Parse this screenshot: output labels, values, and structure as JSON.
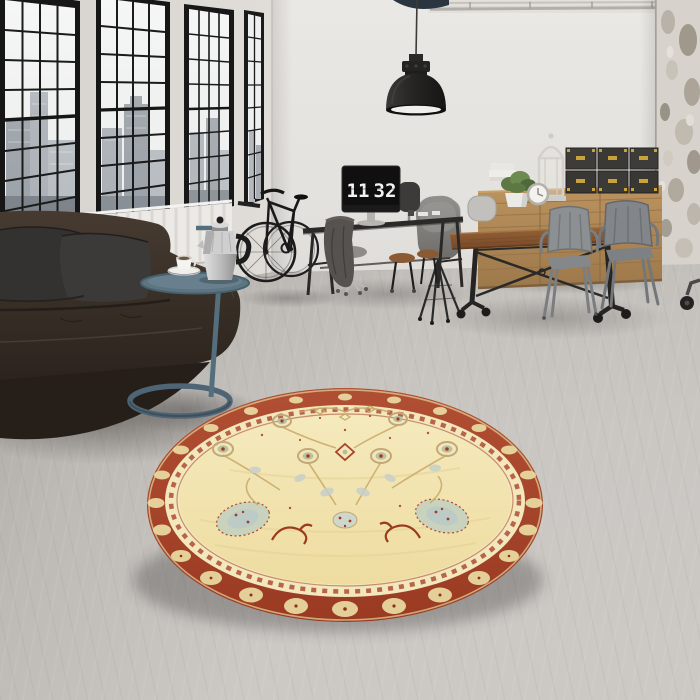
{
  "scene": {
    "type": "interior-product-photo",
    "subject": "Round cream and red oriental rug in an industrial loft living room",
    "monitor_clock": {
      "hours": "11",
      "minutes": "32"
    }
  },
  "objects": [
    "loft-windows",
    "city-view",
    "radiator",
    "leather-sofa",
    "throw-pillows",
    "side-table",
    "moka-pot",
    "coffee-cup",
    "wall-bike",
    "work-desk",
    "flip-clock-monitor",
    "office-stools",
    "draped-blanket",
    "pendant-lamp",
    "ceiling-pipe",
    "dining-table",
    "shell-chairs",
    "tolix-armchairs",
    "wood-sideboard",
    "storage-trunks",
    "potted-plant",
    "lantern",
    "table-clock",
    "distressed-wall",
    "concrete-floor",
    "round-oriental-rug"
  ],
  "palette": {
    "wall": "#e6e3df",
    "left_wall": "#dcd8d4",
    "window_frame": "#161616",
    "window_glass": "#eef0f0",
    "city_silhouette": "#9aa0a6",
    "radiator": "#eceae6",
    "floor_light": "#cac7c3",
    "floor_dark": "#9b9894",
    "sofa_leather": "#3a322b",
    "sofa_pillow": "#323030",
    "side_table_teal": "#5d7482",
    "moka_pot_silver": "#c9c9c9",
    "desk_iron": "#2b2927",
    "monitor_screen": "#121212",
    "clock_digits": "#f3f3f3",
    "dining_wood": "#8a5a33",
    "sideboard_wood": "#b28a57",
    "chair_metal_grey": "#85888a",
    "trunk_black": "#3a3936",
    "trunk_brass": "#c9a23a",
    "plant_green": "#5d7843",
    "lamp_black": "#232323",
    "rug_field_cream": "#f0e2ac",
    "rug_border_red": "#a63f27",
    "rug_sage": "#b3bd9e",
    "rug_pale_blue": "#c6d0ca",
    "rug_vine_tan": "#c8a96a"
  }
}
